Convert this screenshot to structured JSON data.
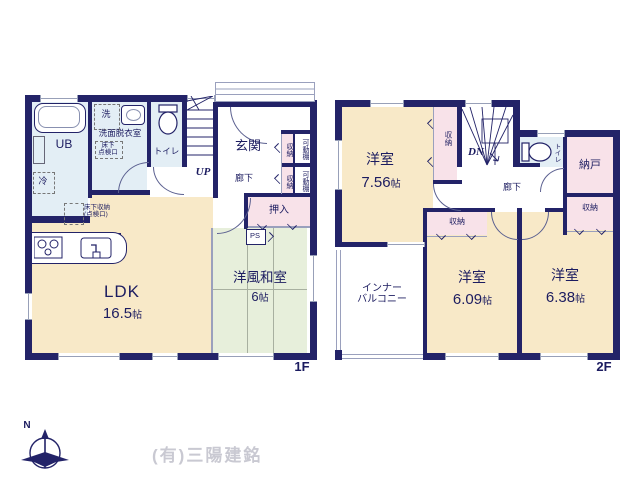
{
  "palette": {
    "wall": "#232368",
    "cream": "#f8e9c8",
    "pink": "#f8e2e9",
    "green": "#e7efdb",
    "blue": "#e3eef5",
    "text": "#1c1c60"
  },
  "footer": {
    "company": "(有)三陽建銘",
    "compass_n": "N"
  },
  "floor1": {
    "label": "1F",
    "ub": "UB",
    "laundry": "洗",
    "washroom": "洗面脱衣室",
    "hatch_line1": "床下",
    "hatch_line2": "点検口",
    "toilet": "トイレ",
    "up": "UP",
    "entrance": "玄関",
    "hallway": "廊下",
    "storage_top": "収納",
    "shelf_top": "可動棚",
    "storage_bottom": "収納",
    "shelf_bottom": "可動棚",
    "oshiire": "押入",
    "ps": "PS",
    "fridge": "冷",
    "floor_storage_line1": "床下収納",
    "floor_storage_line2": "(点検口)",
    "ldk_name": "LDK",
    "ldk_size": "16.5",
    "ldk_unit": "帖",
    "tatami_name": "洋風和室",
    "tatami_size": "6",
    "tatami_unit": "帖"
  },
  "floor2": {
    "label": "2F",
    "room1_name": "洋室",
    "room1_size": "7.56",
    "room1_unit": "帖",
    "closet_strip": "収納",
    "dn": "DN",
    "toilet": "トイレ",
    "nando": "納戸",
    "closet_right": "収納",
    "hallway": "廊下",
    "closet_mid": "収納",
    "balcony_line1": "インナー",
    "balcony_line2": "バルコニー",
    "room2_name": "洋室",
    "room2_size": "6.09",
    "room2_unit": "帖",
    "room3_name": "洋室",
    "room3_size": "6.38",
    "room3_unit": "帖"
  }
}
